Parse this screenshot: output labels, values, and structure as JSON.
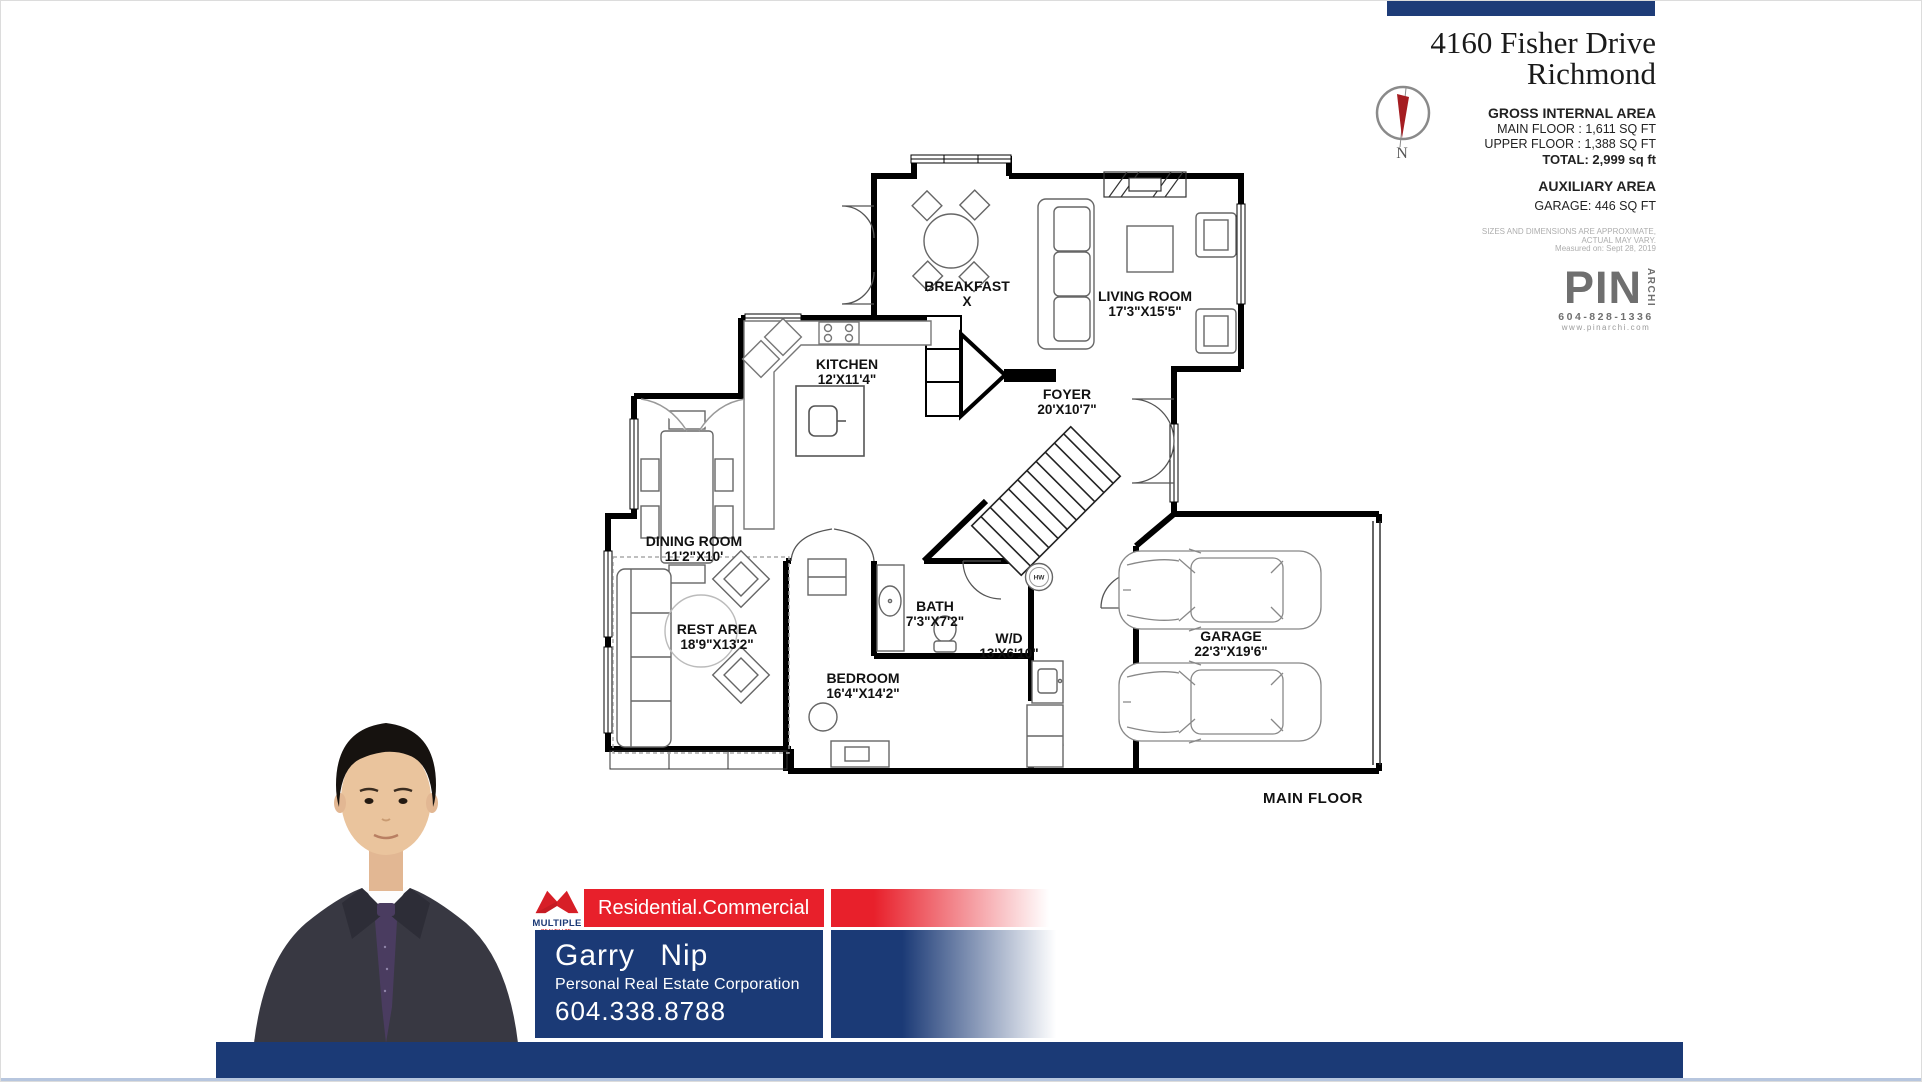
{
  "header": {
    "address_line1": "4160 Fisher Drive",
    "address_line2": "Richmond",
    "compass_label": "N"
  },
  "area_summary": {
    "gross_title": "GROSS INTERNAL AREA",
    "main_floor": "MAIN FLOOR : 1,611 SQ FT",
    "upper_floor": "UPPER FLOOR : 1,388 SQ FT",
    "total": "TOTAL: 2,999 sq ft",
    "auxiliary_title": "AUXILIARY AREA",
    "garage": "GARAGE: 446 SQ FT",
    "disclaimer_line1": "SIZES AND DIMENSIONS ARE APPROXIMATE,",
    "disclaimer_line2": "ACTUAL MAY VARY.",
    "disclaimer_line3": "Measured on: Sept 28, 2019"
  },
  "measurer": {
    "logo": "PIN",
    "logo_side": "ARCHI",
    "phone": "604-828-1336",
    "website": "www.pinarchi.com"
  },
  "floor_plan": {
    "floor_label": "MAIN FLOOR",
    "hot_water_label": "HW",
    "rooms": [
      {
        "name": "BREAKFAST",
        "dimensions": "X"
      },
      {
        "name": "LIVING ROOM",
        "dimensions": "17'3\"X15'5\""
      },
      {
        "name": "KITCHEN",
        "dimensions": "12'X11'4\""
      },
      {
        "name": "FOYER",
        "dimensions": "20'X10'7\""
      },
      {
        "name": "DINING ROOM",
        "dimensions": "11'2\"X10'"
      },
      {
        "name": "REST AREA",
        "dimensions": "18'9\"X13'2\""
      },
      {
        "name": "BEDROOM",
        "dimensions": "16'4\"X14'2\""
      },
      {
        "name": "BATH",
        "dimensions": "7'3\"X7'2\""
      },
      {
        "name": "W/D",
        "dimensions": "13'X6'10\""
      },
      {
        "name": "GARAGE",
        "dimensions": "22'3\"X19'6\""
      }
    ]
  },
  "agent": {
    "brokerage_name": "MULTIPLE",
    "brokerage_sub": "REALTY LTD.",
    "tagline": "Residential.Commercial",
    "name": "Garry Nip",
    "title": "Personal Real Estate Corporation",
    "phone": "604.338.8788"
  },
  "colors": {
    "navy": "#1b3a76",
    "top_bar_navy": "#1e3c78",
    "red": "#e8202b",
    "logo_red": "#d71f27",
    "compass_red": "#a51d21",
    "gray_logo": "#6f6f6f",
    "bottom_strip": "#b7c6de"
  }
}
